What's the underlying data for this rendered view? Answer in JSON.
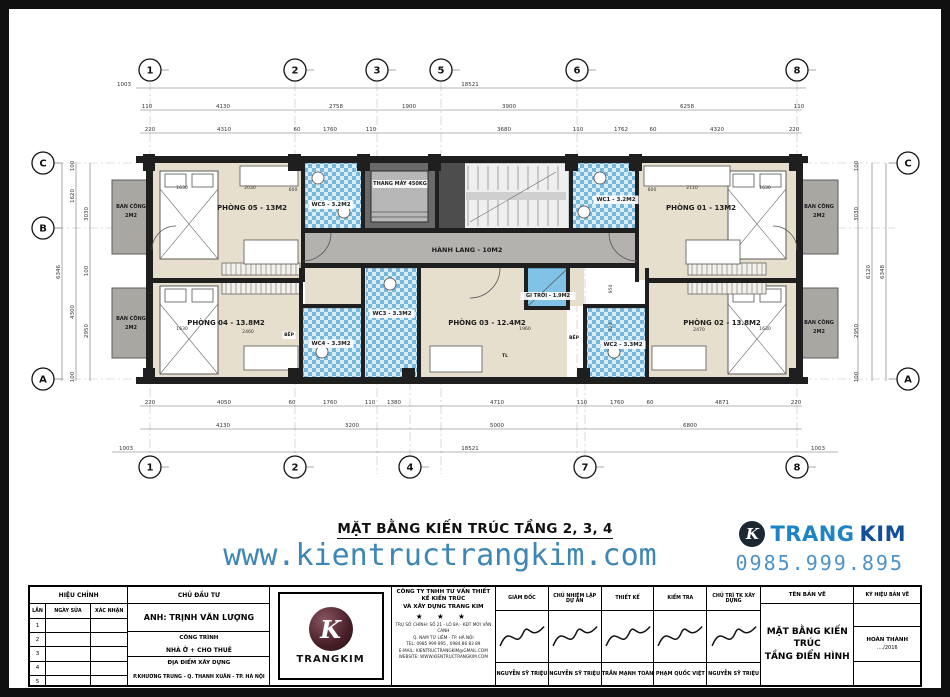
{
  "plan_title": "MẶT BẰNG KIẾN TRÚC TẦNG 2, 3, 4",
  "website": "www.kientructrangkim.com",
  "phone": "0985.999.895",
  "brand": {
    "icon_letter": "K",
    "name_a": "TRANG",
    "name_b": "KIM"
  },
  "plan": {
    "grid_top": [
      {
        "label": "1",
        "x": 150
      },
      {
        "label": "2",
        "x": 295
      },
      {
        "label": "3",
        "x": 377
      },
      {
        "label": "5",
        "x": 441
      },
      {
        "label": "6",
        "x": 577
      },
      {
        "label": "8",
        "x": 797
      }
    ],
    "grid_bottom": [
      {
        "label": "1",
        "x": 150
      },
      {
        "label": "2",
        "x": 295
      },
      {
        "label": "4",
        "x": 410
      },
      {
        "label": "7",
        "x": 585
      },
      {
        "label": "8",
        "x": 797
      }
    ],
    "grid_left": [
      {
        "label": "C",
        "y": 163
      },
      {
        "label": "B",
        "y": 228
      },
      {
        "label": "A",
        "y": 379
      }
    ],
    "grid_right": [
      {
        "label": "C",
        "y": 163
      },
      {
        "label": "A",
        "y": 379
      }
    ],
    "rects": [
      [
        112,
        180,
        38,
        74,
        "bal"
      ],
      [
        112,
        288,
        38,
        70,
        "bal"
      ],
      [
        800,
        180,
        38,
        74,
        "bal"
      ],
      [
        800,
        288,
        38,
        70,
        "bal"
      ],
      [
        152,
        163,
        150,
        117,
        "room"
      ],
      [
        152,
        282,
        150,
        96,
        "room"
      ],
      [
        639,
        163,
        158,
        117,
        "room"
      ],
      [
        649,
        282,
        148,
        96,
        "room"
      ],
      [
        420,
        268,
        146,
        110,
        "room"
      ],
      [
        305,
        268,
        57,
        38,
        "room"
      ],
      [
        568,
        268,
        16,
        38,
        "room"
      ],
      [
        526,
        308,
        41,
        70,
        "room"
      ],
      [
        305,
        163,
        57,
        66,
        "wc"
      ],
      [
        572,
        163,
        64,
        66,
        "wc"
      ],
      [
        366,
        268,
        52,
        110,
        "wc"
      ],
      [
        303,
        308,
        59,
        70,
        "wc"
      ],
      [
        586,
        308,
        60,
        70,
        "wc"
      ],
      [
        305,
        232,
        330,
        32,
        "cor"
      ],
      [
        526,
        268,
        41,
        40,
        "lw"
      ],
      [
        362,
        162,
        75,
        69,
        "liftf"
      ],
      [
        371,
        171,
        57,
        51,
        "liftc"
      ],
      [
        439,
        163,
        130,
        66,
        "stairbg"
      ],
      [
        439,
        163,
        26,
        66,
        "staird"
      ],
      [
        466,
        192,
        100,
        8,
        "stairland"
      ]
    ],
    "walls": [
      [
        136,
        156,
        672,
        7
      ],
      [
        136,
        377,
        672,
        7
      ],
      [
        146,
        163,
        7,
        214
      ],
      [
        796,
        163,
        7,
        214
      ],
      [
        301,
        158,
        4,
        124
      ],
      [
        361,
        158,
        4,
        74
      ],
      [
        435,
        158,
        4,
        74
      ],
      [
        569,
        158,
        4,
        74
      ],
      [
        635,
        158,
        4,
        124
      ],
      [
        303,
        228,
        334,
        5
      ],
      [
        303,
        263,
        334,
        5
      ],
      [
        152,
        278,
        151,
        5
      ],
      [
        645,
        278,
        152,
        5
      ],
      [
        299,
        268,
        4,
        109
      ],
      [
        361,
        268,
        4,
        109
      ],
      [
        417,
        268,
        4,
        109
      ],
      [
        524,
        268,
        4,
        42
      ],
      [
        566,
        268,
        4,
        42
      ],
      [
        524,
        306,
        46,
        4
      ],
      [
        583,
        306,
        4,
        71
      ],
      [
        645,
        268,
        4,
        109
      ],
      [
        303,
        304,
        62,
        4
      ],
      [
        583,
        304,
        66,
        4
      ],
      [
        143,
        154,
        12,
        17
      ],
      [
        288,
        154,
        13,
        17
      ],
      [
        357,
        154,
        13,
        17
      ],
      [
        428,
        154,
        13,
        17
      ],
      [
        565,
        154,
        13,
        17
      ],
      [
        629,
        154,
        13,
        17
      ],
      [
        789,
        154,
        13,
        17
      ],
      [
        143,
        368,
        12,
        16
      ],
      [
        288,
        368,
        13,
        16
      ],
      [
        402,
        368,
        13,
        16
      ],
      [
        577,
        368,
        13,
        16
      ],
      [
        789,
        368,
        13,
        16
      ]
    ],
    "beds": [
      [
        160,
        171,
        58,
        88
      ],
      [
        160,
        286,
        58,
        88
      ],
      [
        728,
        171,
        58,
        88
      ],
      [
        728,
        286,
        58,
        88
      ]
    ],
    "wardrobes": [
      [
        222,
        263,
        78,
        12
      ],
      [
        222,
        282,
        78,
        12
      ],
      [
        688,
        263,
        78,
        12
      ],
      [
        688,
        282,
        78,
        12
      ]
    ],
    "furniture": [
      [
        240,
        166,
        58,
        20
      ],
      [
        644,
        166,
        86,
        20
      ],
      [
        244,
        240,
        54,
        24
      ],
      [
        686,
        240,
        54,
        24
      ],
      [
        244,
        346,
        54,
        24
      ],
      [
        652,
        346,
        54,
        24
      ],
      [
        430,
        346,
        52,
        26
      ]
    ],
    "fixtures": [
      [
        318,
        178,
        6
      ],
      [
        344,
        212,
        6
      ],
      [
        600,
        178,
        6
      ],
      [
        584,
        212,
        6
      ],
      [
        390,
        284,
        6
      ],
      [
        322,
        352,
        6
      ],
      [
        614,
        352,
        6
      ]
    ],
    "paths": [
      "M331 233 A28 28 0 0 1 303 261",
      "M609 233 A28 28 0 0 0 637 261",
      "M500 268 A30 30 0 0 1 470 298",
      "M371 217 L428 217",
      "M371 212 L428 212",
      "M528 306 L566 270",
      "M152 250 A24 24 0 0 1 176 226",
      "M797 250 A24 24 0 0 0 773 226"
    ],
    "dimlines": [
      [
        136,
        88,
        806,
        88
      ],
      [
        140,
        110,
        802,
        110
      ],
      [
        140,
        133,
        802,
        133
      ],
      [
        140,
        406,
        802,
        406
      ],
      [
        140,
        429,
        802,
        429
      ],
      [
        112,
        452,
        838,
        452
      ],
      [
        62,
        163,
        62,
        381
      ],
      [
        76,
        163,
        76,
        381
      ],
      [
        90,
        163,
        90,
        381
      ],
      [
        858,
        163,
        858,
        381
      ],
      [
        872,
        163,
        872,
        381
      ],
      [
        886,
        163,
        886,
        381
      ]
    ],
    "labels": [
      [
        "PHÒNG 05 - 13M2",
        252,
        210,
        7,
        0
      ],
      [
        "WC5 - 3.2M2",
        331,
        206,
        5.5,
        1
      ],
      [
        "THANG MÁY 450KG",
        400,
        185,
        5,
        1
      ],
      [
        "WC1 - 3.2M2",
        616,
        201,
        5.5,
        1
      ],
      [
        "PHÒNG 01 - 13M2",
        701,
        210,
        7,
        0
      ],
      [
        "HÀNH LANG - 10M2",
        467,
        252,
        6.5,
        0
      ],
      [
        "PHÒNG 04 - 13.8M2",
        226,
        325,
        7,
        0
      ],
      [
        "WC4 - 3.3M2",
        331,
        345,
        5.5,
        1
      ],
      [
        "WC3 - 3.3M2",
        392,
        315,
        5.5,
        1
      ],
      [
        "GI TRỜI - 1.9M2",
        548,
        297,
        5,
        1
      ],
      [
        "PHÒNG 03 - 12.4M2",
        487,
        325,
        7,
        0
      ],
      [
        "WC2 - 3.3M2",
        623,
        346,
        5.5,
        1
      ],
      [
        "PHÒNG 02 - 13.8M2",
        722,
        325,
        7,
        0
      ],
      [
        "BAN CÔNG",
        131,
        208,
        5,
        0
      ],
      [
        "2M2",
        131,
        217,
        5,
        0
      ],
      [
        "BAN CÔNG",
        131,
        320,
        5,
        0
      ],
      [
        "2M2",
        131,
        329,
        5,
        0
      ],
      [
        "BAN CÔNG",
        819,
        208,
        5,
        0
      ],
      [
        "2M2",
        819,
        217,
        5,
        0
      ],
      [
        "BAN CÔNG",
        819,
        324,
        5,
        0
      ],
      [
        "2M2",
        819,
        333,
        5,
        0
      ],
      [
        "BẾP",
        289,
        336,
        4.5,
        1
      ],
      [
        "BẾP",
        574,
        339,
        4.5,
        1
      ],
      [
        "TL",
        505,
        357,
        4.5,
        0
      ]
    ],
    "dims": [
      [
        "1003",
        124,
        86,
        0
      ],
      [
        "18521",
        470,
        86,
        0
      ],
      [
        "110",
        147,
        108,
        0
      ],
      [
        "4130",
        223,
        108,
        0
      ],
      [
        "2758",
        336,
        108,
        0
      ],
      [
        "1900",
        409,
        108,
        0
      ],
      [
        "3900",
        509,
        108,
        0
      ],
      [
        "6258",
        687,
        108,
        0
      ],
      [
        "110",
        799,
        108,
        0
      ],
      [
        "220",
        150,
        131,
        0
      ],
      [
        "4310",
        224,
        131,
        0
      ],
      [
        "60",
        297,
        131,
        0
      ],
      [
        "1760",
        330,
        131,
        0
      ],
      [
        "110",
        371,
        131,
        0
      ],
      [
        "3680",
        504,
        131,
        0
      ],
      [
        "110",
        578,
        131,
        0
      ],
      [
        "1762",
        621,
        131,
        0
      ],
      [
        "60",
        653,
        131,
        0
      ],
      [
        "4320",
        717,
        131,
        0
      ],
      [
        "220",
        794,
        131,
        0
      ],
      [
        "220",
        150,
        404,
        0
      ],
      [
        "4050",
        224,
        404,
        0
      ],
      [
        "60",
        292,
        404,
        0
      ],
      [
        "1760",
        330,
        404,
        0
      ],
      [
        "110",
        370,
        404,
        0
      ],
      [
        "1380",
        394,
        404,
        0
      ],
      [
        "4710",
        497,
        404,
        0
      ],
      [
        "110",
        582,
        404,
        0
      ],
      [
        "1760",
        617,
        404,
        0
      ],
      [
        "60",
        650,
        404,
        0
      ],
      [
        "4871",
        722,
        404,
        0
      ],
      [
        "220",
        796,
        404,
        0
      ],
      [
        "4130",
        223,
        427,
        0
      ],
      [
        "3200",
        352,
        427,
        0
      ],
      [
        "5000",
        497,
        427,
        0
      ],
      [
        "6800",
        690,
        427,
        0
      ],
      [
        "1003",
        126,
        450,
        0
      ],
      [
        "18521",
        470,
        450,
        0
      ],
      [
        "1003",
        818,
        450,
        0
      ],
      [
        "6346",
        60,
        272,
        1
      ],
      [
        "1620",
        74,
        196,
        1
      ],
      [
        "4300",
        74,
        312,
        1
      ],
      [
        "100",
        74,
        166,
        1
      ],
      [
        "100",
        74,
        377,
        1
      ],
      [
        "3030",
        88,
        214,
        1
      ],
      [
        "100",
        88,
        271,
        1
      ],
      [
        "2950",
        88,
        331,
        1
      ],
      [
        "3030",
        858,
        214,
        1
      ],
      [
        "2950",
        858,
        331,
        1
      ],
      [
        "100",
        858,
        166,
        1
      ],
      [
        "100",
        858,
        377,
        1
      ],
      [
        "6120",
        870,
        272,
        1
      ],
      [
        "6348",
        884,
        272,
        1
      ],
      [
        "1630",
        182,
        189,
        0,
        4.6
      ],
      [
        "2030",
        250,
        189,
        0,
        4.6
      ],
      [
        "600",
        293,
        191,
        0,
        4.6
      ],
      [
        "600",
        652,
        191,
        0,
        4.6
      ],
      [
        "2110",
        692,
        189,
        0,
        4.6
      ],
      [
        "1630",
        765,
        189,
        0,
        4.6
      ],
      [
        "1630",
        182,
        330,
        0,
        4.6
      ],
      [
        "2460",
        248,
        333,
        0,
        4.6
      ],
      [
        "1960",
        525,
        330,
        0,
        4.6
      ],
      [
        "2470",
        699,
        331,
        0,
        4.6
      ],
      [
        "1630",
        765,
        330,
        0,
        4.6
      ],
      [
        "950",
        612,
        289,
        1,
        4.6
      ],
      [
        "320",
        612,
        327,
        1,
        4.6
      ]
    ]
  },
  "footer": {
    "revision": {
      "title": "HIỆU CHỈNH",
      "cols": [
        "LẦN",
        "NGÀY SỬA",
        "XÁC NHẬN"
      ],
      "rows": [
        "1",
        "2",
        "3",
        "4",
        "5"
      ]
    },
    "owner": {
      "header": "CHỦ ĐẦU TƯ",
      "name": "ANH: TRỊNH VĂN LƯỢNG",
      "project_label": "CÔNG TRÌNH",
      "project": "NHÀ Ở + CHO THUÊ",
      "site_label": "ĐỊA ĐIỂM XÂY DỰNG",
      "site": "P.KHƯƠNG TRUNG - Q. THANH XUÂN - TP. HÀ NỘI"
    },
    "logo_letter": "K",
    "logo_text": "TRANGKIM",
    "company": {
      "line1": "CÔNG TY TNHH TƯ VẤN THIẾT KẾ KIẾN TRÚC",
      "line2": "VÀ XÂY DỰNG TRANG KIM",
      "stars": "★ ★ ★",
      "details": [
        "TRỤ SỞ CHÍNH: SỐ 21 - LÔ 8A - KĐT MỚI VÂN CANH",
        "Q. NAM TỪ LIÊM - TP. HÀ NỘI",
        "TEL: 0985 999 895 , 0984 86 83 89",
        "E-MAIL: KIENTRUCTRANGKIM@GMAIL.COM",
        "WEBSITE: WWW.KIENTRUCTRANGKIM.COM"
      ]
    },
    "signatures": [
      {
        "role": "GIÁM ĐỐC",
        "name": "NGUYỄN SỸ TRIỆU"
      },
      {
        "role": "CHỦ NHIỆM LẬP DỰ ÁN",
        "name": "NGUYỄN SỸ TRIỆU"
      },
      {
        "role": "THIẾT KẾ",
        "name": "TRẦN MẠNH TOÀN"
      },
      {
        "role": "KIỂM TRA",
        "name": "PHẠM QUỐC VIỆT"
      },
      {
        "role": "CHỦ TRÌ TK XÂY DỰNG",
        "name": "NGUYỄN SỸ TRIỆU"
      }
    ],
    "drawing": {
      "header": "TÊN BẢN VẼ",
      "name_line1": "MẶT BẰNG KIẾN TRÚC",
      "name_line2": "TẦNG ĐIỂN HÌNH"
    },
    "code": {
      "header": "KÝ HIỆU BẢN VẼ",
      "status": "HOÀN THÀNH",
      "date": "..../2016"
    }
  }
}
